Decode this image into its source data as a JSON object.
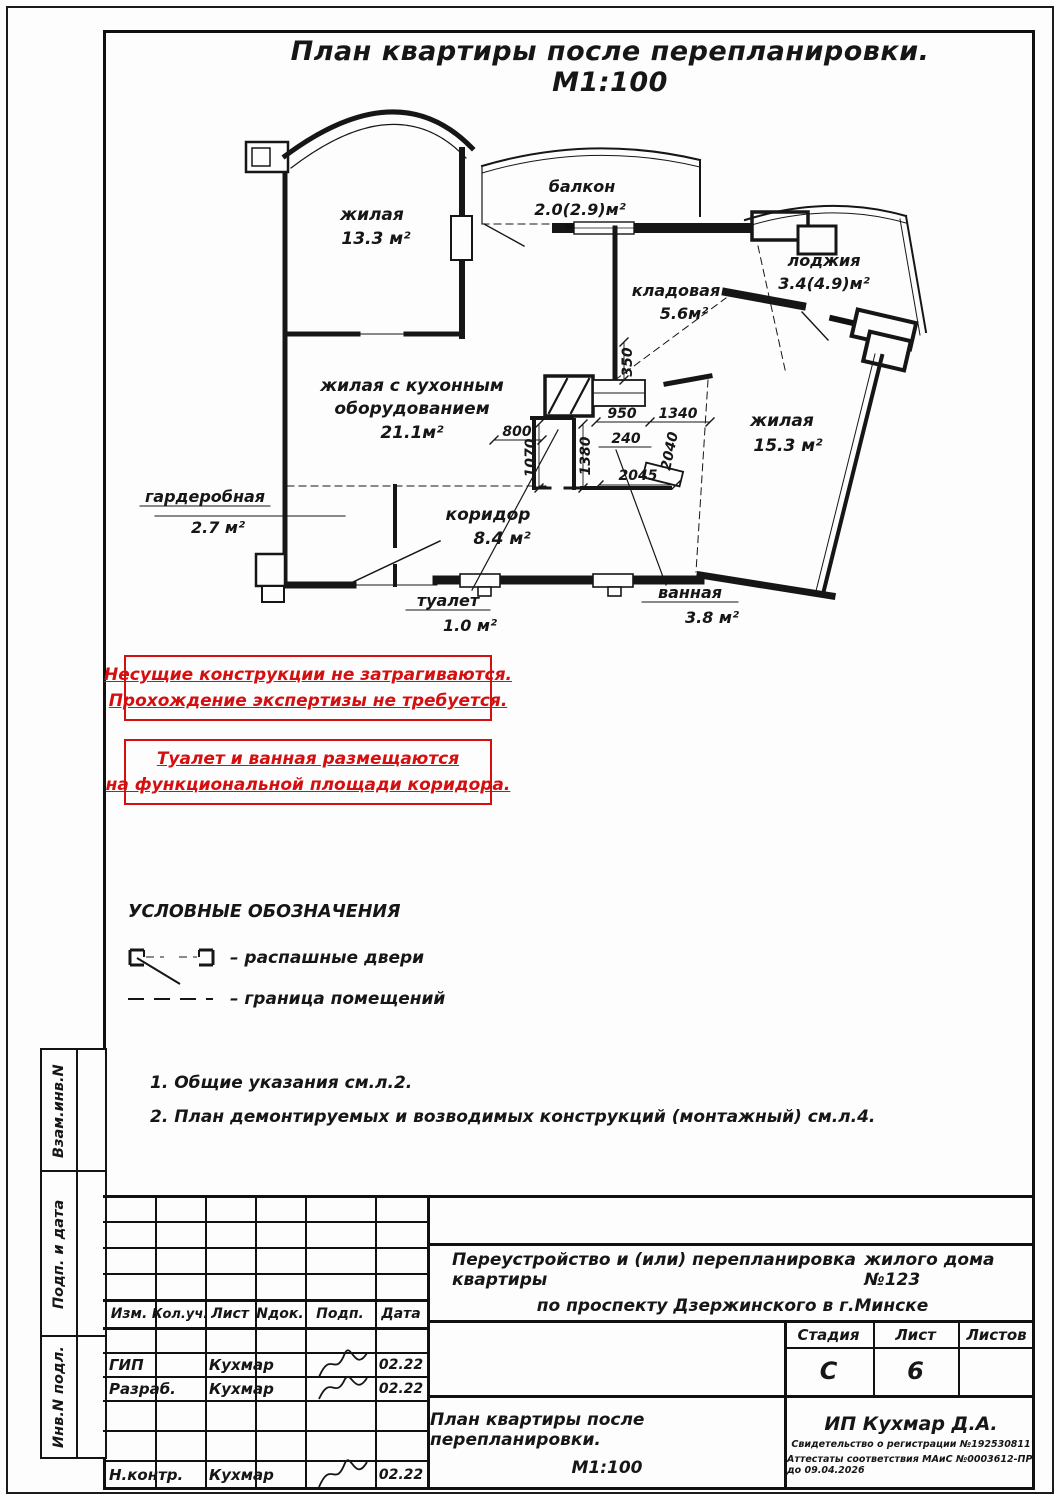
{
  "sheet": {
    "title": "План квартиры после перепланировки. М1:100"
  },
  "plan": {
    "rooms": {
      "living1": {
        "name": "жилая",
        "area": "13.3 м²"
      },
      "balcony": {
        "name": "балкон",
        "area": "2.0(2.9)м²"
      },
      "storage": {
        "name": "кладовая",
        "area": "5.6м²"
      },
      "loggia": {
        "name": "лоджия",
        "area": "3.4(4.9)м²"
      },
      "living2": {
        "name": "жилая",
        "area": "15.3 м²"
      },
      "kitchen_living": {
        "line1": "жилая с кухонным",
        "line2": "оборудованием",
        "area": "21.1м²"
      },
      "wardrobe": {
        "name": "гардеробная",
        "area": "2.7 м²"
      },
      "corridor": {
        "name": "коридор",
        "area": "8.4 м²"
      },
      "wc": {
        "name": "туалет",
        "area": "1.0 м²"
      },
      "bath": {
        "name": "ванная",
        "area": "3.8 м²"
      }
    },
    "dims": {
      "d350": "350",
      "d800": "800",
      "d950": "950",
      "d240": "240",
      "d1340": "1340",
      "d2040": "2040",
      "d1070": "1070",
      "d1380": "1380",
      "d2045": "2045"
    }
  },
  "notices": [
    {
      "line1": "Несущие конструкции не затрагиваются.",
      "line2": "Прохождение экспертизы не требуется."
    },
    {
      "line1": "Туалет и ванная размещаются",
      "line2": "на функциональной площади коридора."
    }
  ],
  "legend": {
    "heading": "УСЛОВНЫЕ ОБОЗНАЧЕНИЯ",
    "door_label": "–  распашные двери",
    "boundary_label": "–  граница помещений"
  },
  "notes": [
    "1.  Общие указания см.л.2.",
    "2.  План демонтируемых и возводимых конструкций (монтажный) см.л.4."
  ],
  "sidebar": {
    "labels": [
      "Взам.инв.N",
      "Подп. и дата",
      "Инв.N подл."
    ]
  },
  "titleblock": {
    "columns": {
      "izm": "Изм.",
      "kol": "Кол.уч.",
      "list": "Лист",
      "ndok": "Nдок.",
      "podp": "Подп.",
      "data": "Дата"
    },
    "rows": [
      {
        "role": "ГИП",
        "name": "Кухмар",
        "date": "02.22"
      },
      {
        "role": "Разраб.",
        "name": "Кухмар",
        "date": "02.22"
      },
      {
        "role": "Н.контр.",
        "name": "Кухмар",
        "date": "02.22"
      }
    ],
    "project": {
      "line1": "Переустройство и (или) перепланировка квартиры",
      "line1b": "жилого дома №123",
      "line2": "по проспекту Дзержинского в г.Минске"
    },
    "stage": {
      "label": "Стадия",
      "value": "С"
    },
    "sheet_no": {
      "label": "Лист",
      "value": "6"
    },
    "sheets_total": {
      "label": "Листов",
      "value": ""
    },
    "drawing_name": {
      "line1": "План квартиры после перепланировки.",
      "line2": "М1:100"
    },
    "firm": {
      "name": "ИП Кухмар Д.А.",
      "cert1": "Свидетельство о регистрации №192530811",
      "cert2": "Аттестаты соответствия МАиС №0003612-ПР до 09.04.2026"
    }
  },
  "colors": {
    "red": "#d40f0f",
    "ink": "#161616"
  }
}
